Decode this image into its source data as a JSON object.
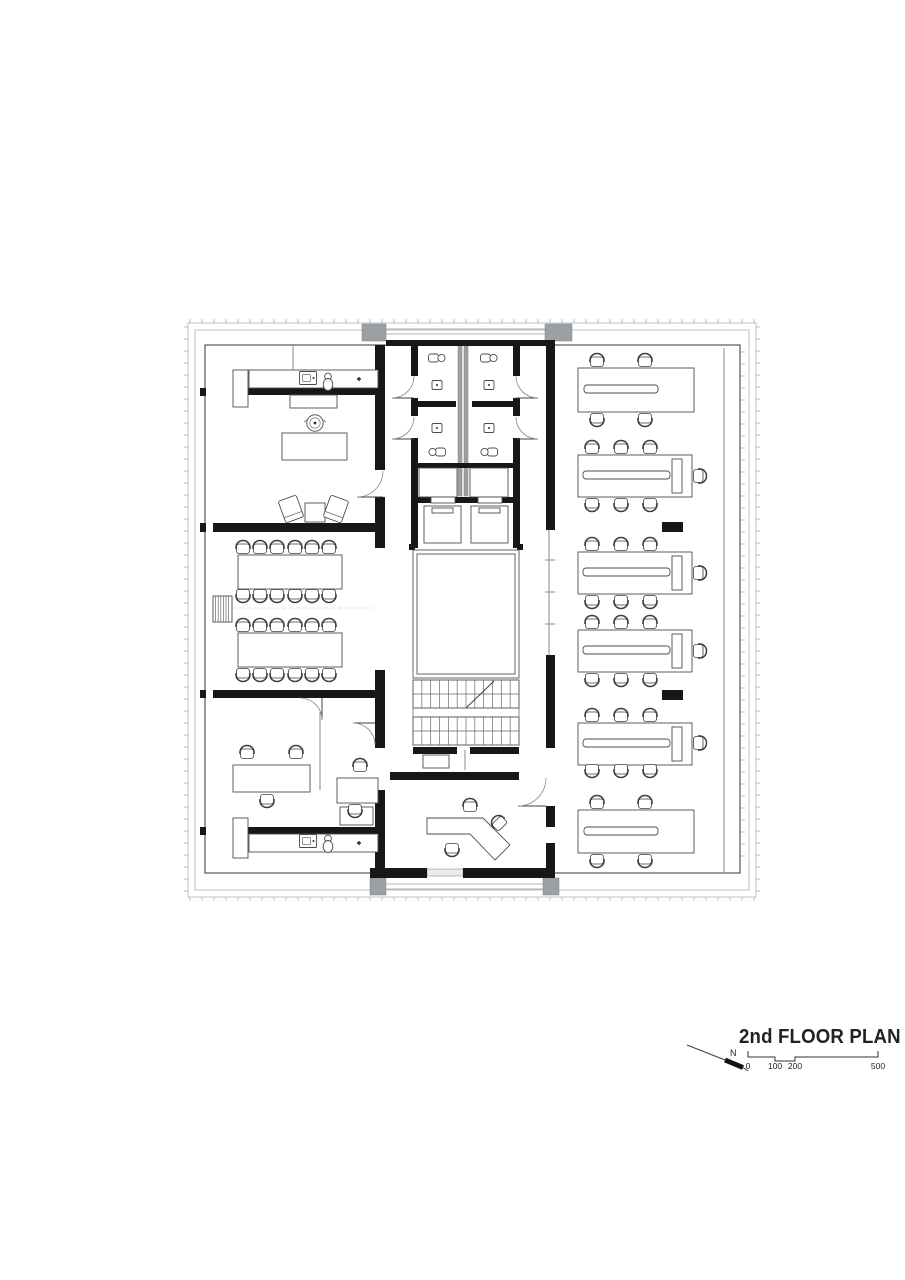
{
  "title_block": {
    "title": "2nd FLOOR PLAN",
    "north_label": "N",
    "scale_labels": [
      "0",
      "100",
      "200",
      "500"
    ],
    "scale_tick_x": [
      748,
      775,
      795,
      878
    ],
    "scale_bar_path": "M748,1051 L748,1057 L775,1057 L775,1061 L795,1061 L795,1057 L878,1057 L878,1051",
    "scale_label_y": 1069,
    "north_arrow": {
      "line": [
        687,
        1045,
        725,
        1060
      ],
      "thick": [
        725,
        1060,
        743,
        1067.5
      ],
      "tail": [
        743,
        1067.5,
        748,
        1071
      ],
      "label_pos": [
        730,
        1056
      ]
    }
  },
  "colors": {
    "background": "#ffffff",
    "wall": "#171717",
    "grey_fill": "#9aa0a3",
    "line_dark": "#3f3f3f",
    "line_light": "#b9bcbe",
    "text": "#242424"
  },
  "floor_plan": {
    "facade": {
      "outer": [
        188,
        323,
        568,
        574
      ],
      "mid": [
        195,
        330,
        554,
        560
      ],
      "inner": [
        205,
        345,
        535,
        528
      ],
      "tick_step": 12,
      "tick_len": 4,
      "right_mullion_x": 741,
      "right_mullion_range": [
        352,
        868
      ]
    },
    "grey_rects": [
      [
        362,
        324,
        24,
        17
      ],
      [
        545,
        324,
        27,
        17
      ],
      [
        370,
        878,
        16,
        17
      ],
      [
        543,
        878,
        16,
        17
      ],
      [
        458,
        344,
        4,
        152
      ],
      [
        464,
        344,
        4,
        152
      ]
    ],
    "grey_lines": [
      [
        386,
        329,
        545,
        329
      ],
      [
        386,
        334,
        545,
        334
      ],
      [
        386,
        884,
        543,
        884
      ],
      [
        386,
        889,
        543,
        889
      ]
    ],
    "glass_rects": [
      [
        412,
        341,
        38,
        4
      ],
      [
        470,
        341,
        42,
        4
      ],
      [
        427,
        869,
        36,
        7
      ]
    ],
    "walls": [
      [
        248,
        388,
        130,
        7
      ],
      [
        213,
        523,
        165,
        9
      ],
      [
        213,
        690,
        170,
        8
      ],
      [
        248,
        827,
        130,
        7
      ],
      [
        375,
        345,
        10,
        125
      ],
      [
        375,
        497,
        10,
        51
      ],
      [
        375,
        670,
        10,
        78
      ],
      [
        375,
        790,
        10,
        88
      ],
      [
        200,
        388,
        6,
        8
      ],
      [
        200,
        523,
        6,
        9
      ],
      [
        200,
        690,
        6,
        8
      ],
      [
        200,
        827,
        6,
        8
      ],
      [
        386,
        340,
        26,
        6
      ],
      [
        450,
        340,
        20,
        6
      ],
      [
        512,
        340,
        34,
        6
      ],
      [
        411,
        340,
        109,
        6
      ],
      [
        411,
        340,
        7,
        36
      ],
      [
        411,
        398,
        7,
        18
      ],
      [
        411,
        438,
        7,
        110
      ],
      [
        513,
        340,
        7,
        36
      ],
      [
        513,
        398,
        7,
        18
      ],
      [
        513,
        438,
        7,
        110
      ],
      [
        418,
        401,
        38,
        6
      ],
      [
        472,
        401,
        41,
        6
      ],
      [
        418,
        463,
        95,
        5
      ],
      [
        411,
        497,
        20,
        6
      ],
      [
        455,
        497,
        23,
        6
      ],
      [
        502,
        497,
        18,
        6
      ],
      [
        413,
        747,
        44,
        7
      ],
      [
        470,
        747,
        49,
        7
      ],
      [
        390,
        772,
        21,
        8
      ],
      [
        411,
        772,
        108,
        8
      ],
      [
        546,
        340,
        9,
        190
      ],
      [
        546,
        655,
        9,
        93
      ],
      [
        546,
        806,
        9,
        21
      ],
      [
        546,
        843,
        9,
        35
      ],
      [
        370,
        868,
        57,
        10
      ],
      [
        463,
        868,
        84,
        10
      ],
      [
        660,
        386,
        23,
        11
      ],
      [
        662,
        522,
        21,
        10
      ],
      [
        662,
        690,
        21,
        10
      ],
      [
        660,
        826,
        23,
        11
      ],
      [
        409,
        544,
        6,
        6
      ],
      [
        517,
        544,
        6,
        6
      ]
    ],
    "furniture_rects": [
      [
        233,
        370,
        15,
        37
      ],
      [
        249,
        370,
        129,
        18
      ],
      [
        290,
        395,
        47,
        13
      ],
      [
        282,
        433,
        65,
        27
      ],
      [
        305,
        503,
        20,
        19
      ],
      [
        238,
        555,
        104,
        34
      ],
      [
        238,
        633,
        104,
        34
      ],
      [
        233,
        765,
        77,
        27
      ],
      [
        337,
        778,
        41,
        25
      ],
      [
        233,
        818,
        15,
        40
      ],
      [
        340,
        807,
        33,
        18
      ],
      [
        249,
        834,
        129,
        18
      ],
      [
        419,
        468,
        38,
        29
      ],
      [
        470,
        468,
        38,
        29
      ],
      [
        424,
        506,
        37,
        37
      ],
      [
        471,
        506,
        37,
        37
      ],
      [
        431,
        497,
        24,
        6
      ],
      [
        478,
        497,
        24,
        6
      ],
      [
        432,
        508,
        21,
        5
      ],
      [
        479,
        508,
        21,
        5
      ],
      [
        423,
        755,
        26,
        13
      ],
      [
        578,
        368,
        116,
        44
      ],
      [
        578,
        455,
        114,
        42
      ],
      [
        578,
        552,
        114,
        42
      ],
      [
        578,
        630,
        114,
        42
      ],
      [
        578,
        723,
        114,
        42
      ],
      [
        578,
        810,
        116,
        43
      ],
      [
        672,
        459,
        10,
        34
      ],
      [
        672,
        556,
        10,
        34
      ],
      [
        672,
        634,
        10,
        34
      ],
      [
        672,
        727,
        10,
        34
      ]
    ],
    "desk_spines": [
      [
        584,
        385,
        74,
        8
      ],
      [
        583,
        471,
        87,
        8
      ],
      [
        583,
        568,
        87,
        8
      ],
      [
        583,
        646,
        87,
        8
      ],
      [
        583,
        739,
        87,
        8
      ],
      [
        584,
        827,
        74,
        8
      ]
    ],
    "atrium": {
      "outer": [
        413,
        550,
        106,
        128
      ],
      "inner": [
        417,
        554,
        98,
        120
      ]
    },
    "stairs": {
      "flights": [
        [
          413,
          680,
          106,
          28,
          1
        ],
        [
          413,
          717,
          106,
          28,
          0
        ]
      ],
      "connectors": [
        [
          413,
          708,
          413,
          717
        ],
        [
          519,
          708,
          519,
          717
        ]
      ]
    },
    "thin_lines": [
      [
        296,
        370,
        296,
        388
      ],
      [
        318,
        370,
        318,
        388
      ],
      [
        340,
        370,
        340,
        388
      ],
      [
        296,
        834,
        296,
        852
      ],
      [
        318,
        834,
        318,
        852
      ],
      [
        340,
        834,
        340,
        852
      ],
      [
        293,
        345,
        293,
        370
      ],
      [
        320,
        712,
        320,
        790
      ],
      [
        622,
        368,
        622,
        412
      ],
      [
        660,
        368,
        660,
        412
      ],
      [
        682,
        368,
        682,
        412
      ],
      [
        622,
        810,
        622,
        853
      ],
      [
        660,
        810,
        660,
        853
      ],
      [
        682,
        810,
        682,
        853
      ],
      [
        607,
        455,
        607,
        497
      ],
      [
        636,
        455,
        636,
        497
      ],
      [
        607,
        552,
        607,
        594
      ],
      [
        636,
        552,
        636,
        594
      ],
      [
        607,
        630,
        607,
        672
      ],
      [
        636,
        630,
        636,
        672
      ],
      [
        607,
        723,
        607,
        765
      ],
      [
        636,
        723,
        636,
        765
      ],
      [
        724,
        348,
        724,
        872
      ],
      [
        549,
        530,
        549,
        655
      ],
      [
        545,
        560,
        555,
        560
      ],
      [
        545,
        592,
        555,
        592
      ],
      [
        545,
        624,
        555,
        624
      ],
      [
        465,
        750,
        465,
        770
      ],
      [
        425,
        495,
        443,
        470
      ],
      [
        472,
        495,
        490,
        470
      ]
    ],
    "dashed_lines": [
      [
        233,
        608,
        374,
        608
      ]
    ],
    "radiator": [
      213,
      596,
      19,
      26
    ],
    "plant": [
      315,
      423
    ],
    "diamonds": [
      [
        359,
        379
      ],
      [
        359,
        843
      ]
    ],
    "kitchen_sinks": [
      [
        308,
        378
      ],
      [
        308,
        841
      ]
    ],
    "kitchen_toilets": [
      [
        328,
        381
      ],
      [
        328,
        843
      ]
    ],
    "wc_toilets": [
      [
        437,
        358,
        0
      ],
      [
        489,
        358,
        0
      ],
      [
        437,
        452,
        180
      ],
      [
        489,
        452,
        180
      ]
    ],
    "wc_basins": [
      [
        437,
        385
      ],
      [
        489,
        385
      ],
      [
        437,
        428
      ],
      [
        489,
        428
      ]
    ],
    "reception_desk": [
      [
        427,
        818
      ],
      [
        483,
        818
      ],
      [
        510,
        845
      ],
      [
        495,
        860
      ],
      [
        470,
        834
      ],
      [
        427,
        834
      ]
    ],
    "lounge_chairs": [
      [
        291,
        509,
        -20
      ],
      [
        336,
        509,
        20
      ]
    ],
    "chairs": [
      [
        243,
        548,
        0
      ],
      [
        260,
        548,
        0
      ],
      [
        277,
        548,
        0
      ],
      [
        295,
        548,
        0
      ],
      [
        312,
        548,
        0
      ],
      [
        329,
        548,
        0
      ],
      [
        243,
        595,
        180
      ],
      [
        260,
        595,
        180
      ],
      [
        277,
        595,
        180
      ],
      [
        295,
        595,
        180
      ],
      [
        312,
        595,
        180
      ],
      [
        329,
        595,
        180
      ],
      [
        243,
        626,
        0
      ],
      [
        260,
        626,
        0
      ],
      [
        277,
        626,
        0
      ],
      [
        295,
        626,
        0
      ],
      [
        312,
        626,
        0
      ],
      [
        329,
        626,
        0
      ],
      [
        243,
        674,
        180
      ],
      [
        260,
        674,
        180
      ],
      [
        277,
        674,
        180
      ],
      [
        295,
        674,
        180
      ],
      [
        312,
        674,
        180
      ],
      [
        329,
        674,
        180
      ],
      [
        247,
        753,
        0
      ],
      [
        296,
        753,
        0
      ],
      [
        267,
        800,
        180
      ],
      [
        360,
        766,
        0
      ],
      [
        355,
        810,
        180
      ],
      [
        470,
        806,
        0
      ],
      [
        499,
        823,
        -45
      ],
      [
        452,
        849,
        180
      ],
      [
        597,
        361,
        0
      ],
      [
        645,
        361,
        0
      ],
      [
        597,
        419,
        180
      ],
      [
        645,
        419,
        180
      ],
      [
        592,
        448,
        0
      ],
      [
        621,
        448,
        0
      ],
      [
        650,
        448,
        0
      ],
      [
        592,
        504,
        180
      ],
      [
        621,
        504,
        180
      ],
      [
        650,
        504,
        180
      ],
      [
        699,
        476,
        90
      ],
      [
        592,
        545,
        0
      ],
      [
        621,
        545,
        0
      ],
      [
        650,
        545,
        0
      ],
      [
        592,
        601,
        180
      ],
      [
        621,
        601,
        180
      ],
      [
        650,
        601,
        180
      ],
      [
        699,
        573,
        90
      ],
      [
        592,
        623,
        0
      ],
      [
        621,
        623,
        0
      ],
      [
        650,
        623,
        0
      ],
      [
        592,
        679,
        180
      ],
      [
        621,
        679,
        180
      ],
      [
        650,
        679,
        180
      ],
      [
        699,
        651,
        90
      ],
      [
        592,
        716,
        0
      ],
      [
        621,
        716,
        0
      ],
      [
        650,
        716,
        0
      ],
      [
        592,
        770,
        180
      ],
      [
        621,
        770,
        180
      ],
      [
        650,
        770,
        180
      ],
      [
        699,
        743,
        90
      ],
      [
        597,
        803,
        0
      ],
      [
        645,
        803,
        0
      ],
      [
        597,
        860,
        180
      ],
      [
        645,
        860,
        180
      ]
    ],
    "doors": [
      {
        "leaf": [
          357,
          497,
          383,
          497
        ],
        "arc": "M357,497A26,26 0 0 0 383,471"
      },
      {
        "leaf": [
          322,
          698,
          322,
          720
        ],
        "arc": "M322,720A22,22 0 0 0 300,698"
      },
      {
        "leaf": [
          353,
          723,
          375,
          723
        ],
        "arc": "M353,723A22,22 0 0 1 375,745"
      },
      {
        "leaf": [
          392,
          398,
          414,
          398
        ],
        "arc": "M392,398A22,22 0 0 0 414,376"
      },
      {
        "leaf": [
          392,
          439,
          414,
          439
        ],
        "arc": "M392,439A22,22 0 0 0 414,417"
      },
      {
        "leaf": [
          516,
          398,
          538,
          398
        ],
        "arc": "M538,398A22,22 0 0 1 516,376"
      },
      {
        "leaf": [
          516,
          439,
          538,
          439
        ],
        "arc": "M538,439A22,22 0 0 1 516,417"
      },
      {
        "leaf": [
          518,
          806,
          546,
          806
        ],
        "arc": "M518,806A28,28 0 0 0 546,778"
      }
    ]
  }
}
